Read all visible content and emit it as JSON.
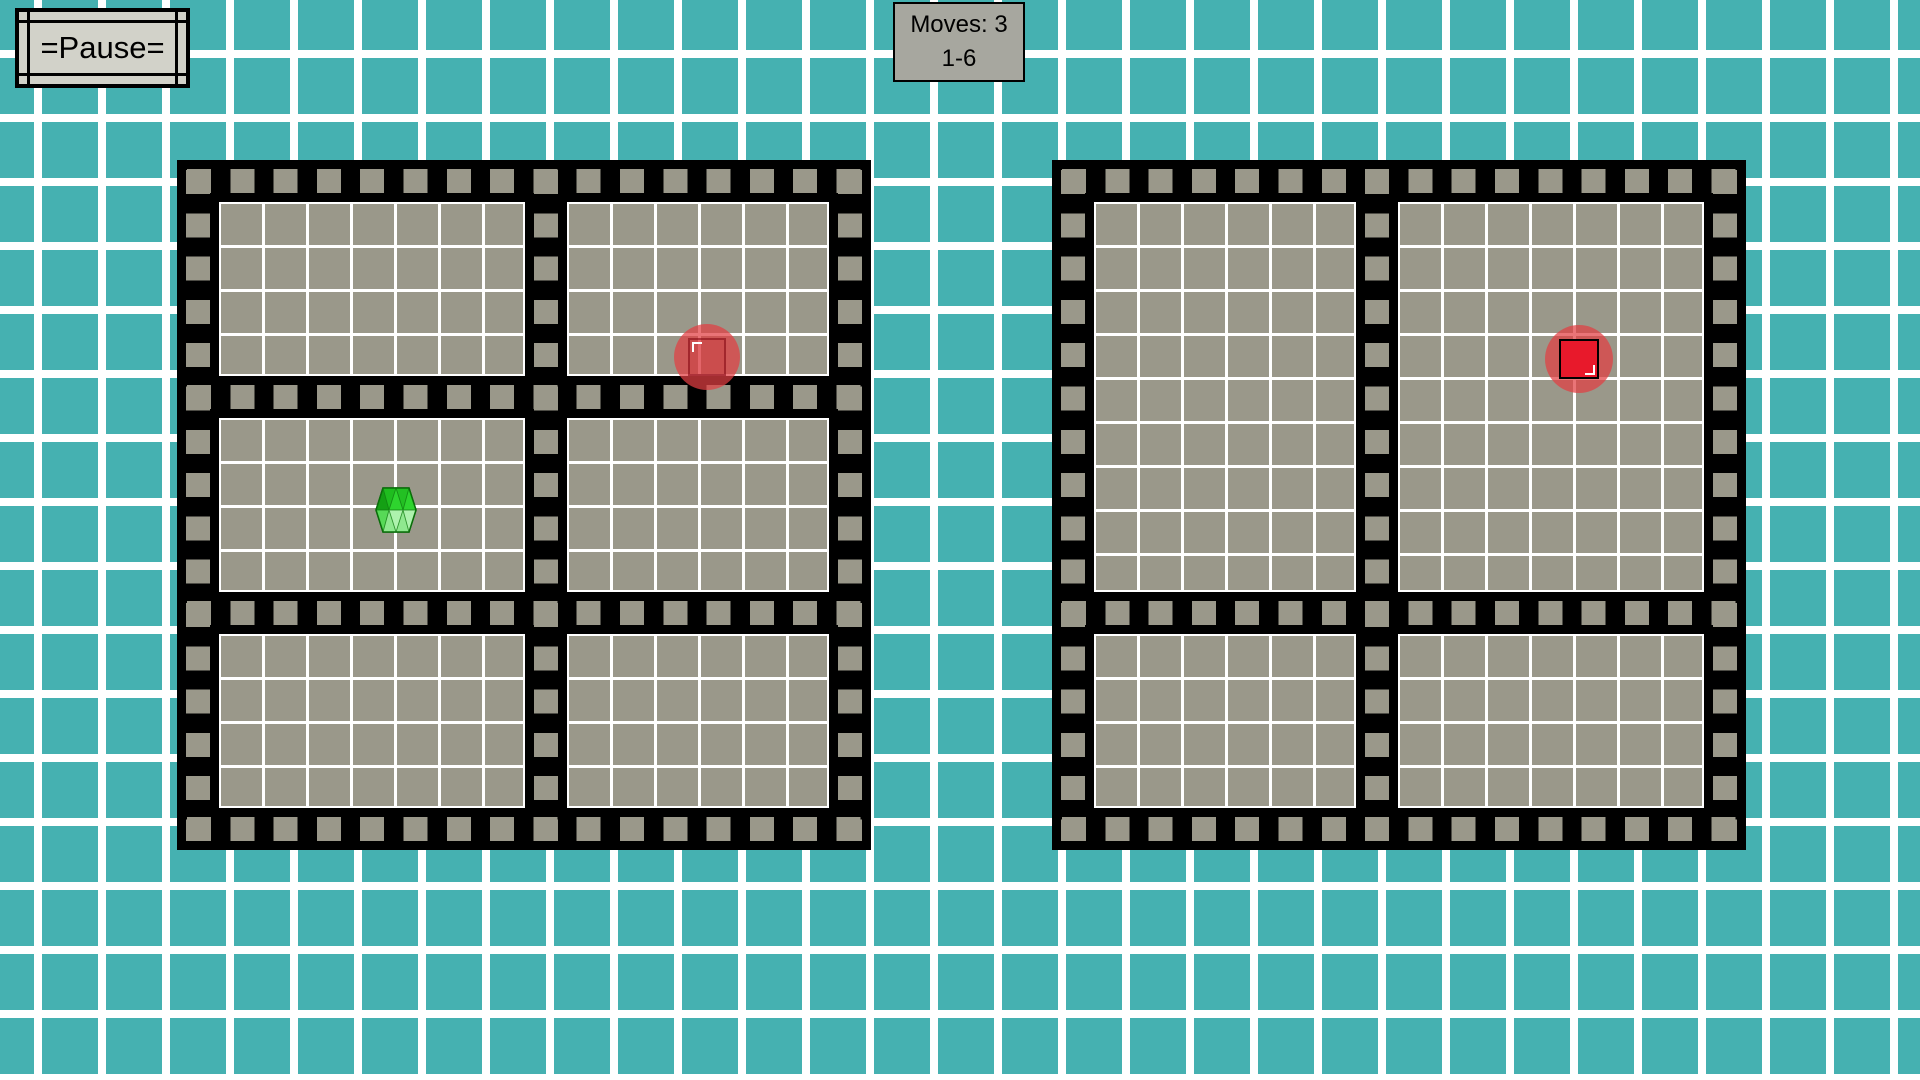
{
  "ui": {
    "pause_label": "=Pause=",
    "moves_line1": "Moves: 3",
    "moves_line2": "1-6"
  },
  "colors": {
    "background_teal": "#45b1b1",
    "grid_line_white": "#ffffff",
    "board_frame_black": "#000000",
    "panel_gray": "#9a988a",
    "counter_box_gray": "#a7a79f",
    "pause_button_gray": "#d2d2c9",
    "piece_red_solid": "#e8192b",
    "piece_red_halo": "rgba(226,62,66,0.72)",
    "piece_green": "#27c627"
  },
  "boards": [
    {
      "id": "left",
      "style": "black film-strip frame with gray sprocket squares",
      "panels": [
        {
          "position": "top-left",
          "grid": "7x4"
        },
        {
          "position": "top-right",
          "grid": "6x4"
        },
        {
          "position": "middle-left",
          "grid": "7x4"
        },
        {
          "position": "middle-right",
          "grid": "6x4"
        },
        {
          "position": "bottom-left",
          "grid": "7x4"
        },
        {
          "position": "bottom-right",
          "grid": "6x4"
        }
      ]
    },
    {
      "id": "right",
      "style": "black film-strip frame with gray sprocket squares",
      "panels": [
        {
          "position": "top-left",
          "grid": "6x9"
        },
        {
          "position": "top-right",
          "grid": "7x9"
        },
        {
          "position": "bottom-left",
          "grid": "6x4"
        },
        {
          "position": "bottom-right",
          "grid": "7x4"
        }
      ]
    }
  ],
  "pieces": [
    {
      "name": "green-gem-piece",
      "shape": "hex-gem",
      "board": "left",
      "panel": "middle-left",
      "x": 375,
      "y": 487,
      "w": 42,
      "h": 46
    },
    {
      "name": "red-ghost-target",
      "shape": "red-circle-ghost",
      "board": "left",
      "panel": "top-right",
      "x": 674,
      "y": 324,
      "w": 66,
      "h": 66
    },
    {
      "name": "red-square-piece",
      "shape": "red-circle-solid",
      "board": "right",
      "panel": "top-right",
      "x": 1545,
      "y": 325,
      "w": 68,
      "h": 68
    }
  ]
}
